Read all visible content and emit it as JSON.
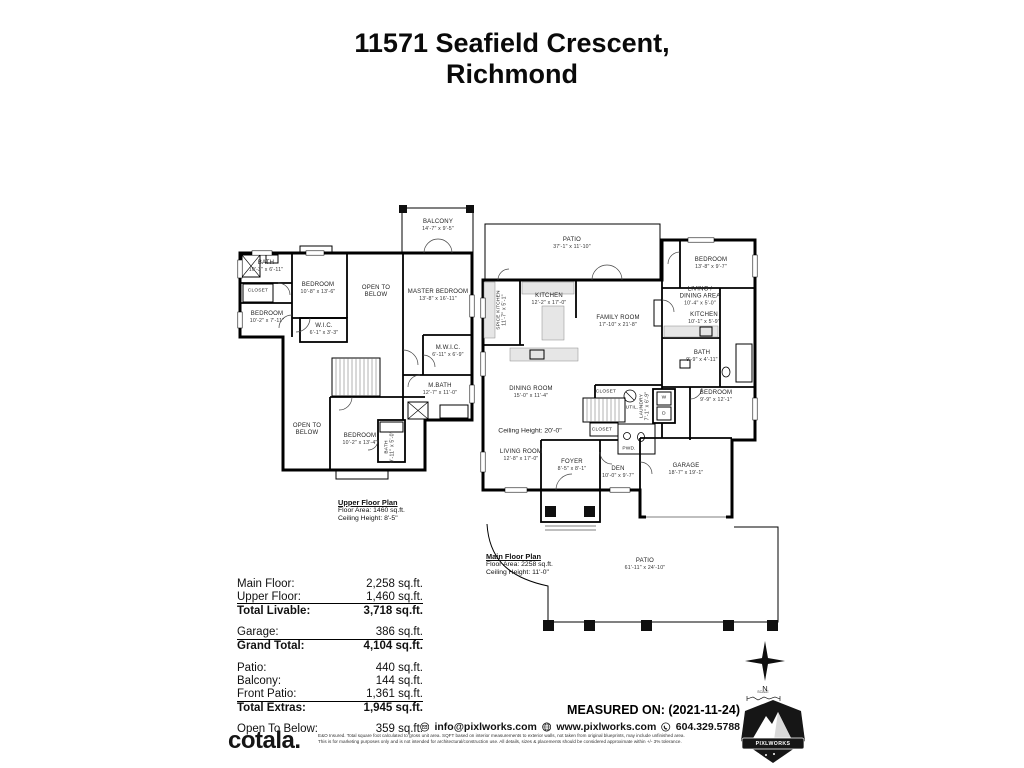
{
  "title": {
    "line1": "11571 Seafield Crescent,",
    "line2": "Richmond"
  },
  "upper_plan": {
    "caption": {
      "title": "Upper Floor Plan",
      "area": "Floor Area: 1460 sq.ft.",
      "ceiling": "Ceiling Height: 8'-5\""
    },
    "rooms": [
      {
        "name": "BALCONY",
        "dims": "14'-7\" x 9'-5\""
      },
      {
        "name": "BATH",
        "dims": "10'-3\" x 6'-11\""
      },
      {
        "name": "CLOSET",
        "dims": ""
      },
      {
        "name": "BEDROOM",
        "dims": "10'-8\" x 13'-6\""
      },
      {
        "name": "BEDROOM",
        "dims": "10'-2\" x 7'-11\""
      },
      {
        "name": "OPEN TO BELOW",
        "dims": ""
      },
      {
        "name": "MASTER BEDROOM",
        "dims": "13'-8\" x 16'-11\""
      },
      {
        "name": "W.I.C.",
        "dims": "6'-1\" x 3'-3\""
      },
      {
        "name": "M.W.I.C.",
        "dims": "6'-11\" x 6'-9\""
      },
      {
        "name": "M.BATH",
        "dims": "12'-7\" x 11'-0\""
      },
      {
        "name": "OPEN TO BELOW",
        "dims": ""
      },
      {
        "name": "BEDROOM",
        "dims": "10'-2\" x 13'-4\""
      },
      {
        "name": "BATH",
        "dims": "9'-11\" x 5'-0\""
      }
    ]
  },
  "main_plan": {
    "caption": {
      "title": "Main Floor Plan",
      "area": "Floor Area: 2258 sq.ft.",
      "ceiling": "Ceiling Height: 11'-0\""
    },
    "ceiling_note": "Ceiling Height: 20'-0\"",
    "appliances": {
      "washer": "W",
      "dryer": "D"
    },
    "rooms": [
      {
        "name": "PATIO",
        "dims": "37'-1\" x 11'-10\""
      },
      {
        "name": "SPICE KITCHEN",
        "dims": "11'-7\" x 5'-1\""
      },
      {
        "name": "KITCHEN",
        "dims": "12'-2\" x 17'-0\""
      },
      {
        "name": "FAMILY ROOM",
        "dims": "17'-10\" x 21'-8\""
      },
      {
        "name": "BEDROOM",
        "dims": "13'-8\" x 9'-7\""
      },
      {
        "name": "LIVING / DINING AREA",
        "dims": "10'-4\" x 5'-0\""
      },
      {
        "name": "KITCHEN",
        "dims": "10'-1\" x 5'-9\""
      },
      {
        "name": "BATH",
        "dims": "9'-9\" x 4'-11\""
      },
      {
        "name": "BEDROOM",
        "dims": "9'-9\" x 12'-1\""
      },
      {
        "name": "DINING ROOM",
        "dims": "15'-0\" x 11'-4\""
      },
      {
        "name": "LIVING ROOM",
        "dims": "12'-8\" x 17'-0\""
      },
      {
        "name": "FOYER",
        "dims": "8'-5\" x 8'-1\""
      },
      {
        "name": "DEN",
        "dims": "10'-0\" x 9'-7\""
      },
      {
        "name": "GARAGE",
        "dims": "18'-7\" x 19'-1\""
      },
      {
        "name": "CLOSET",
        "dims": ""
      },
      {
        "name": "UTIL.",
        "dims": ""
      },
      {
        "name": "LAUNDRY",
        "dims": "7'-1\" x 6'-9\""
      },
      {
        "name": "CLOSET",
        "dims": ""
      },
      {
        "name": "PWD.",
        "dims": ""
      },
      {
        "name": "PATIO",
        "dims": "61'-11\" x 24'-10\""
      }
    ]
  },
  "summary": {
    "rows": [
      {
        "label": "Main Floor:",
        "value": "2,258 sq.ft."
      },
      {
        "label": "Upper Floor:",
        "value": "1,460 sq.ft."
      },
      {
        "label": "Total Livable:",
        "value": "3,718 sq.ft."
      },
      {
        "label": "Garage:",
        "value": "386 sq.ft."
      },
      {
        "label": "Grand Total:",
        "value": "4,104 sq.ft."
      },
      {
        "label": "Patio:",
        "value": "440 sq.ft."
      },
      {
        "label": "Balcony:",
        "value": "144 sq.ft."
      },
      {
        "label": "Front Patio:",
        "value": "1,361 sq.ft."
      },
      {
        "label": "Total Extras:",
        "value": "1,945 sq.ft."
      },
      {
        "label": "Open To Below:",
        "value": "359 sq.ft."
      }
    ]
  },
  "compass": {
    "north": "N",
    "scale": "SCALE"
  },
  "footer": {
    "measured_on": "MEASURED ON: (2021-11-24)",
    "brand": "cotala.",
    "email": "info@pixlworks.com",
    "website": "www.pixlworks.com",
    "phone": "604.329.5788",
    "logo_text": "PIXLWORKS",
    "disclaimer1": "E&O Insured.  Total square foot calculated to gross unit area. SQFT based on interior measurements to exterior walls, not taken from original blueprints, may include unfinished area.",
    "disclaimer2": "This is for marketing purposes only and is not intended for architectural/construction use.  All details, sizes & placements should be considered approximate within +/- 3% tolerance."
  }
}
